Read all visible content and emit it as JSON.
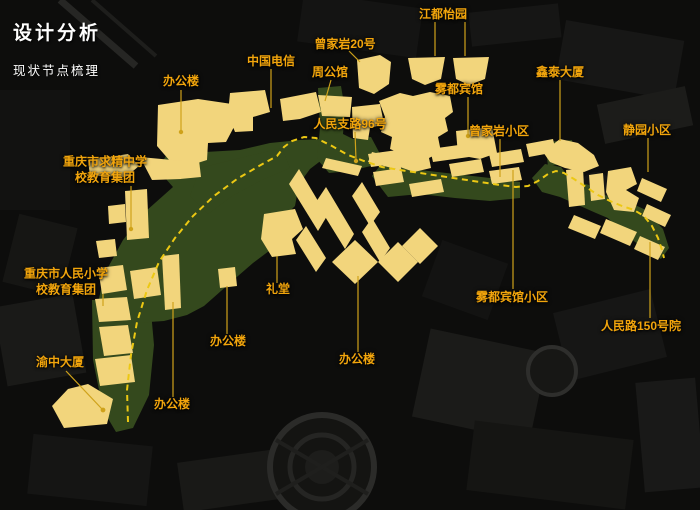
{
  "title": "设计分析",
  "subtitle": "现状节点梳理",
  "colors": {
    "background": "#0d0d0c",
    "building": "#f2d57c",
    "green_area": "#34491d",
    "route_dash": "#ecc813",
    "leader_line": "#cfa21a",
    "label_text": "#f2a50c",
    "title_text": "#ffffff"
  },
  "labels": [
    {
      "id": "office-top",
      "text": "办公楼",
      "x": 181,
      "y": 82
    },
    {
      "id": "china-telecom",
      "text": "中国电信",
      "x": 271,
      "y": 62
    },
    {
      "id": "zengjiayan-no20",
      "text": "曾家岩20号",
      "x": 345,
      "y": 45
    },
    {
      "id": "zhou-mansion",
      "text": "周公馆",
      "x": 330,
      "y": 73
    },
    {
      "id": "jiangdu-garden",
      "text": "江都怡园",
      "x": 443,
      "y": 15
    },
    {
      "id": "wudu-hotel",
      "text": "雾都宾馆",
      "x": 459,
      "y": 90
    },
    {
      "id": "renmin-branch-road-96",
      "text": "人民支路96号",
      "x": 350,
      "y": 125
    },
    {
      "id": "xintai-tower",
      "text": "鑫泰大厦",
      "x": 560,
      "y": 73
    },
    {
      "id": "zengjiayan-community",
      "text": "曾家岩小区",
      "x": 499,
      "y": 132
    },
    {
      "id": "jingyuan-community",
      "text": "静园小区",
      "x": 647,
      "y": 131
    },
    {
      "id": "qiujing-school",
      "text": "重庆市求精中学",
      "text2": "校教育集团",
      "x": 105,
      "y": 170
    },
    {
      "id": "renmin-primary-school",
      "text": "重庆市人民小学",
      "text2": "校教育集团",
      "x": 66,
      "y": 282
    },
    {
      "id": "auditorium",
      "text": "礼堂",
      "x": 278,
      "y": 290
    },
    {
      "id": "office-mid-left",
      "text": "办公楼",
      "x": 228,
      "y": 342
    },
    {
      "id": "office-center",
      "text": "办公楼",
      "x": 357,
      "y": 360
    },
    {
      "id": "office-bottom",
      "text": "办公楼",
      "x": 172,
      "y": 405
    },
    {
      "id": "yuzhong-tower",
      "text": "渝中大厦",
      "x": 60,
      "y": 363
    },
    {
      "id": "wudu-hotel-community",
      "text": "雾都宾馆小区",
      "x": 512,
      "y": 298
    },
    {
      "id": "renmin-road-150",
      "text": "人民路150号院",
      "x": 641,
      "y": 327
    }
  ]
}
